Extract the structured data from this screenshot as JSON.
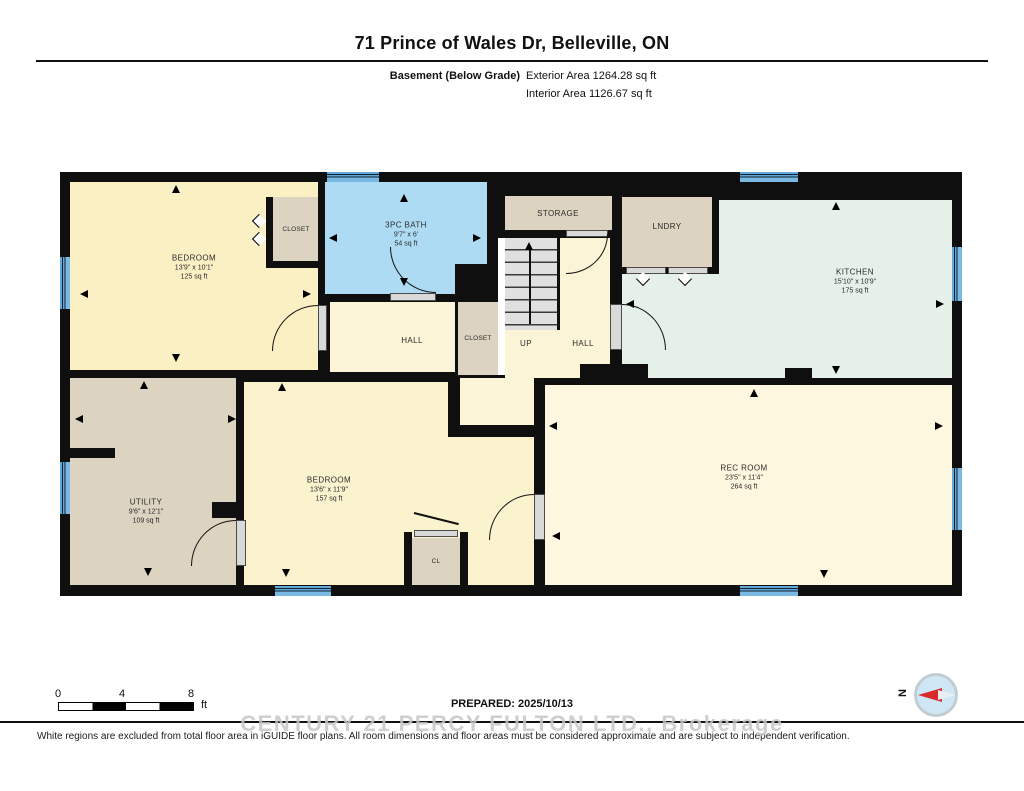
{
  "header": {
    "title": "71 Prince of Wales Dr, Belleville, ON",
    "floor_label": "Basement (Below Grade)",
    "exterior_area": "Exterior Area 1264.28 sq ft",
    "interior_area": "Interior Area 1126.67 sq ft"
  },
  "rooms": {
    "bedroom1": {
      "name": "BEDROOM",
      "dims": "13'9\" x 10'1\"",
      "area": "125 sq ft"
    },
    "closet1": {
      "name": "CLOSET"
    },
    "bath": {
      "name": "3PC BATH",
      "dims": "9'7\" x 6'",
      "area": "54 sq ft"
    },
    "hall1": {
      "name": "HALL"
    },
    "closet2": {
      "name": "CLOSET"
    },
    "storage": {
      "name": "STORAGE"
    },
    "stairs": {
      "name": "UP"
    },
    "hall2": {
      "name": "HALL"
    },
    "laundry": {
      "name": "LNDRY"
    },
    "kitchen": {
      "name": "KITCHEN",
      "dims": "15'10\" x 10'9\"",
      "area": "175 sq ft"
    },
    "utility": {
      "name": "UTILITY",
      "dims": "9'6\" x 12'1\"",
      "area": "109 sq ft"
    },
    "bedroom2": {
      "name": "BEDROOM",
      "dims": "13'6\" x 11'9\"",
      "area": "157 sq ft"
    },
    "rec_room": {
      "name": "REC ROOM",
      "dims": "23'5\" x 11'4\"",
      "area": "264 sq ft"
    },
    "closet3": {
      "name": "CL"
    }
  },
  "scale_bar": {
    "tick0": "0",
    "tick1": "4",
    "tick2": "8",
    "unit": "ft"
  },
  "footer": {
    "prepared": "PREPARED: 2025/10/13",
    "watermark": "CENTURY 21 PERCY FULTON LTD., Brokerage",
    "disclaimer": "White regions are excluded from total floor area in iGUIDE floor plans. All room dimensions and floor areas must be considered approximate and are subject to independent verification."
  },
  "compass": {
    "north_label": "N"
  },
  "colors": {
    "wall": "#0f0f0f",
    "bedroom_yellow": "#FBEFC4",
    "cream_floor": "#FCF4D6",
    "bath_blue": "#ADDBF4",
    "kitchen_mint": "#E5F0E8",
    "utility_tan": "#DCD3C1",
    "rec_cream": "#FDF7DF",
    "window_blue": "#61A8DB",
    "compass_red": "#D92B2B"
  }
}
